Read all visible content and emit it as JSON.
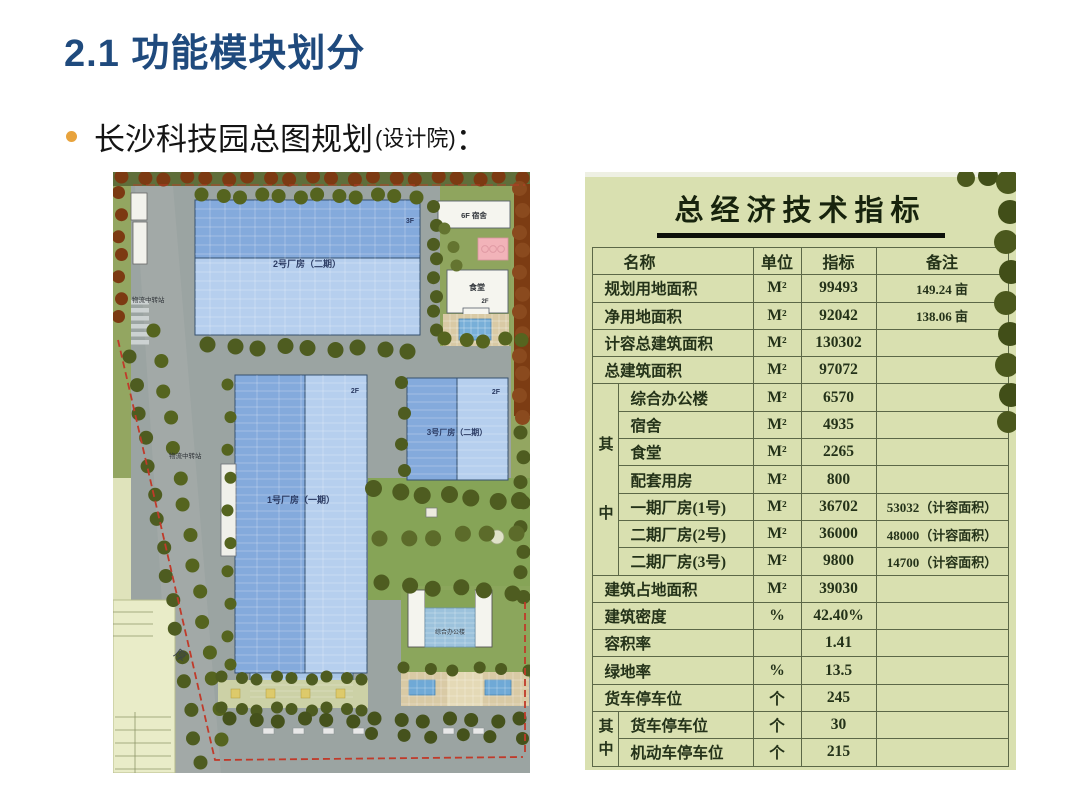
{
  "slide": {
    "title": "2.1 功能模块划分",
    "bullet": "长沙科技园总图规划",
    "bullet_paren": "(设计院)",
    "colon": "："
  },
  "colors": {
    "title_blue": "#1f4a7d",
    "bullet_orange": "#e8a33d",
    "table_background": "#d9e0b0",
    "factory_blue_dark": "#84aadc",
    "factory_blue_light": "#b6cfee",
    "boundary_red": "#c03a2a"
  },
  "plan": {
    "labels": {
      "factory2": "2号厂房（二期）",
      "factory2_floor": "3F",
      "factory1": "1号厂房（一期）",
      "factory1_floor": "2F",
      "factory3": "3号厂房（二期）",
      "factory3_floor": "2F",
      "dorm": "6F 宿舍",
      "canteen": "食堂",
      "canteen_floor": "2F",
      "logistics_a": "物流中转站",
      "logistics_b": "物流中转站",
      "office": "综合办公楼",
      "road": "厚"
    }
  },
  "table": {
    "title": "总经济技术指标",
    "headers": [
      "名称",
      "单位",
      "指标",
      "备注"
    ],
    "rows": [
      {
        "name": "规划用地面积",
        "unit": "M²",
        "value": "99493",
        "note": "149.24 亩"
      },
      {
        "name": "净用地面积",
        "unit": "M²",
        "value": "92042",
        "note": "138.06 亩"
      },
      {
        "name": "计容总建筑面积",
        "unit": "M²",
        "value": "130302",
        "note": ""
      },
      {
        "name": "总建筑面积",
        "unit": "M²",
        "value": "97072",
        "note": ""
      },
      {
        "name": "综合办公楼",
        "unit": "M²",
        "value": "6570",
        "note": ""
      },
      {
        "name": "宿舍",
        "unit": "M²",
        "value": "4935",
        "note": ""
      },
      {
        "name": "食堂",
        "unit": "M²",
        "value": "2265",
        "note": ""
      },
      {
        "name": "配套用房",
        "unit": "M²",
        "value": "800",
        "note": ""
      },
      {
        "name": "一期厂房(1号)",
        "unit": "M²",
        "value": "36702",
        "note": "53032（计容面积）"
      },
      {
        "name": "二期厂房(2号)",
        "unit": "M²",
        "value": "36000",
        "note": "48000（计容面积）"
      },
      {
        "name": "二期厂房(3号)",
        "unit": "M²",
        "value": "9800",
        "note": "14700（计容面积）"
      },
      {
        "name": "建筑占地面积",
        "unit": "M²",
        "value": "39030",
        "note": ""
      },
      {
        "name": "建筑密度",
        "unit": "%",
        "value": "42.40%",
        "note": ""
      },
      {
        "name": "容积率",
        "unit": "",
        "value": "1.41",
        "note": ""
      },
      {
        "name": "绿地率",
        "unit": "%",
        "value": "13.5",
        "note": ""
      },
      {
        "name": "货车停车位",
        "unit": "个",
        "value": "245",
        "note": ""
      },
      {
        "name": "货车停车位",
        "unit": "个",
        "value": "30",
        "note": ""
      },
      {
        "name": "机动车停车位",
        "unit": "个",
        "value": "215",
        "note": ""
      }
    ],
    "groups": [
      {
        "label": "其中",
        "start": 4,
        "span": 7
      },
      {
        "label": "其中",
        "start": 16,
        "span": 2
      }
    ]
  }
}
